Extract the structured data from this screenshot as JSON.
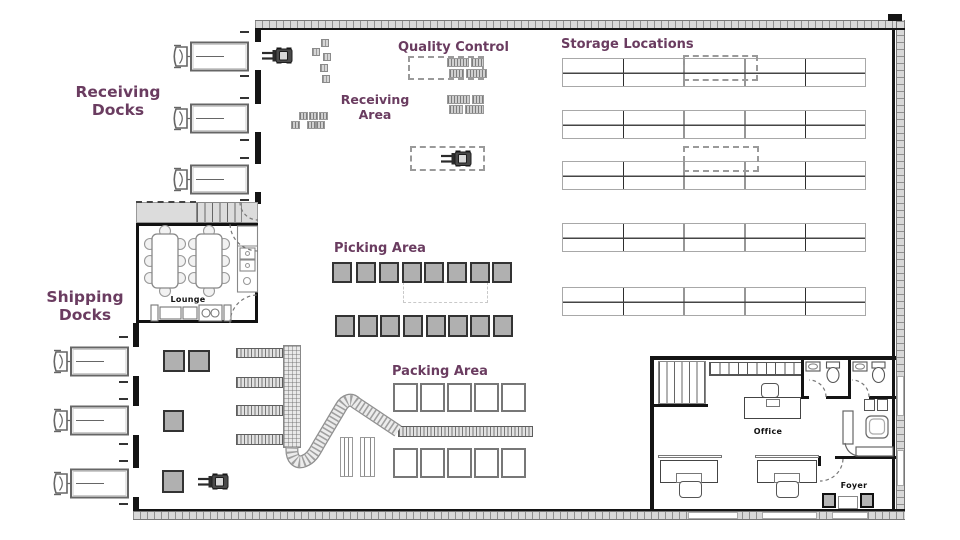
{
  "diagram": {
    "type": "warehouse-floor-plan",
    "labels": {
      "receiving_docks": "Receiving Docks",
      "shipping_docks": "Shipping Docks",
      "quality_control": "Quality Control",
      "storage_locations": "Storage Locations",
      "receiving_area": "Receiving Area",
      "picking_area": "Picking Area",
      "packing_area": "Packing Area",
      "lounge": "Lounge",
      "office": "Office",
      "foyer": "Foyer"
    },
    "colors": {
      "area_label": "#6a3c60",
      "room_label": "#111111",
      "wall": "#141414"
    },
    "counts": {
      "receiving_dock_trucks": 3,
      "shipping_dock_trucks": 3,
      "storage_rack_rows": 5,
      "storage_rack_columns": 5,
      "picking_pallet_rows": 2,
      "picking_pallets_per_row": 8,
      "packing_table_rows": 2,
      "packing_tables_per_row": 5,
      "forklifts": 3,
      "bathrooms": 2
    }
  }
}
